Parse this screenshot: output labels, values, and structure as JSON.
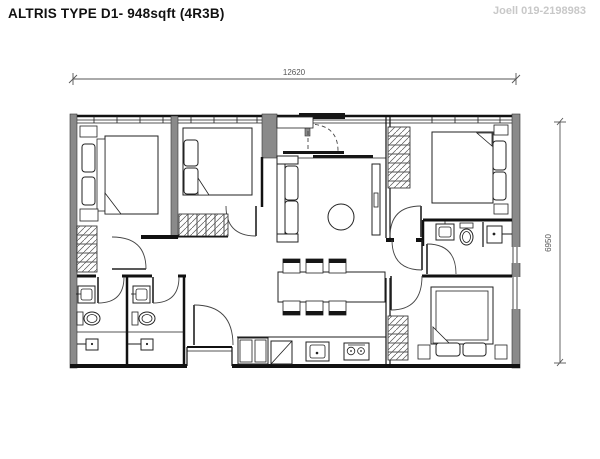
{
  "header": {
    "title": "ALTRIS TYPE D1- 948sqft (4R3B)",
    "watermark": "Joell 019-2198983"
  },
  "dimensions": {
    "width_mm": "12620",
    "height_mm": "6950"
  },
  "colors": {
    "background": "#ffffff",
    "line": "#1c1c1c",
    "wall_fill": "#8a8a8a",
    "watermark": "#c8c8c8",
    "dimension_text": "#555555"
  },
  "plan": {
    "unit_type": "D1",
    "area": "948sqft",
    "layout_code": "4R3B",
    "rooms": [
      "bedroom",
      "bedroom",
      "bedroom",
      "master-bedroom",
      "living-room",
      "dining-area",
      "kitchen",
      "bathroom",
      "bathroom",
      "master-bathroom",
      "balcony",
      "entrance-foyer"
    ]
  }
}
